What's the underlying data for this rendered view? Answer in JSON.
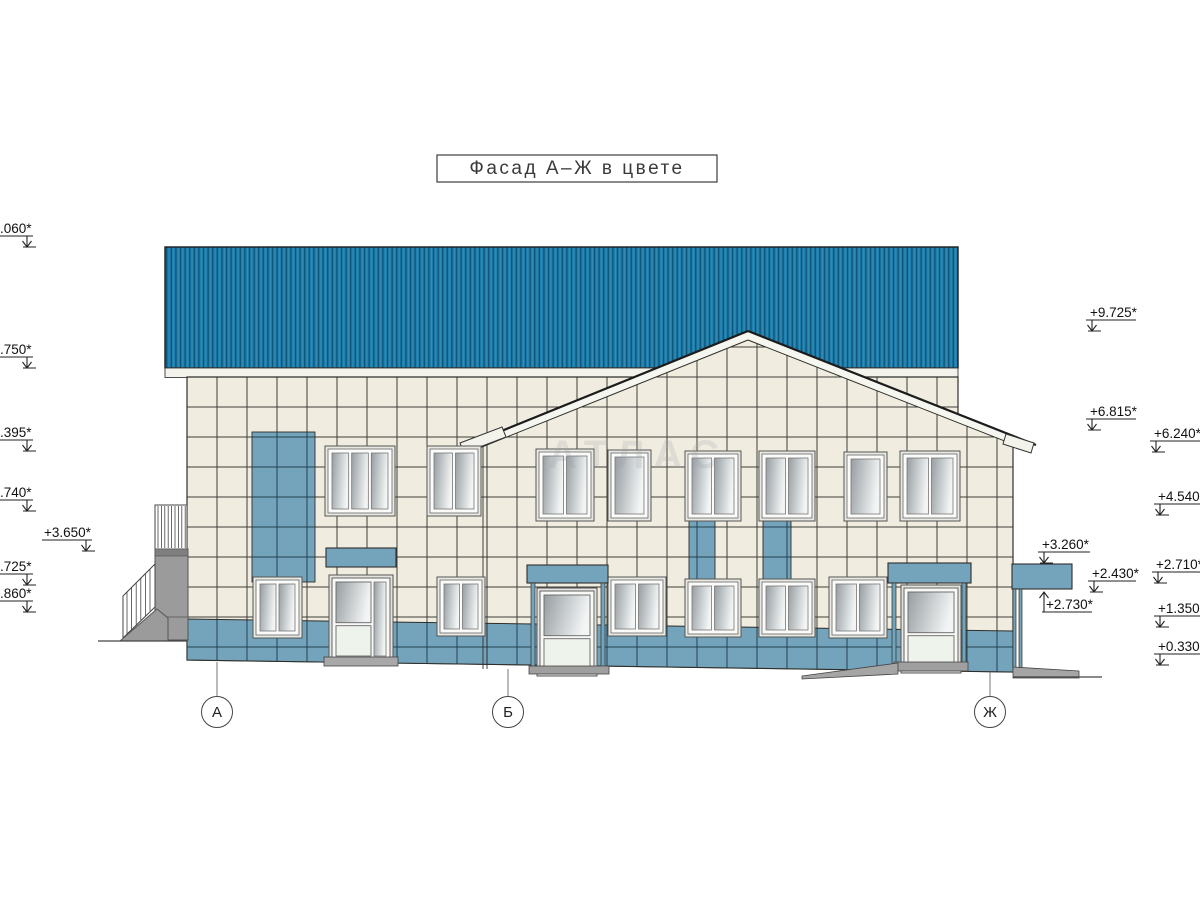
{
  "drawing": {
    "title": "Фасад А–Ж в цвете",
    "watermark": "АТЛАС"
  },
  "axis_markers": [
    {
      "label": "А"
    },
    {
      "label": "Б"
    },
    {
      "label": "Ж"
    }
  ],
  "elevation_marks_left": [
    {
      "label": ".060*"
    },
    {
      "label": ".750*"
    },
    {
      "label": ".395*"
    },
    {
      "label": ".740*"
    },
    {
      "label": "+3.650*"
    },
    {
      "label": ".725*"
    },
    {
      "label": ".860*"
    }
  ],
  "elevation_marks_right": [
    {
      "label": "+9.725*"
    },
    {
      "label": "+6.815*"
    },
    {
      "label": "+6.240*"
    },
    {
      "label": "+4.540*"
    },
    {
      "label": "+3.260*"
    },
    {
      "label": "+2.430*"
    },
    {
      "label": "+2.730*"
    },
    {
      "label": "+2.710*"
    },
    {
      "label": "+1.350*"
    },
    {
      "label": "+0.330*"
    }
  ],
  "colors": {
    "roof_blue": "#1f7fad",
    "roof_line": "#0d5477",
    "accent_blue": "#74a3bc",
    "tile_cream": "#f1ece0",
    "tile_grid": "#3e3e37",
    "blue_grid": "#24414f",
    "fascia_white": "#f3f3eb",
    "line_dark": "#2e2e2a",
    "concrete_gray": "#9b9b9b",
    "glass_dark": "#979da1",
    "glass_light": "#f3f5f5",
    "door_panel": "#eef4ec"
  }
}
